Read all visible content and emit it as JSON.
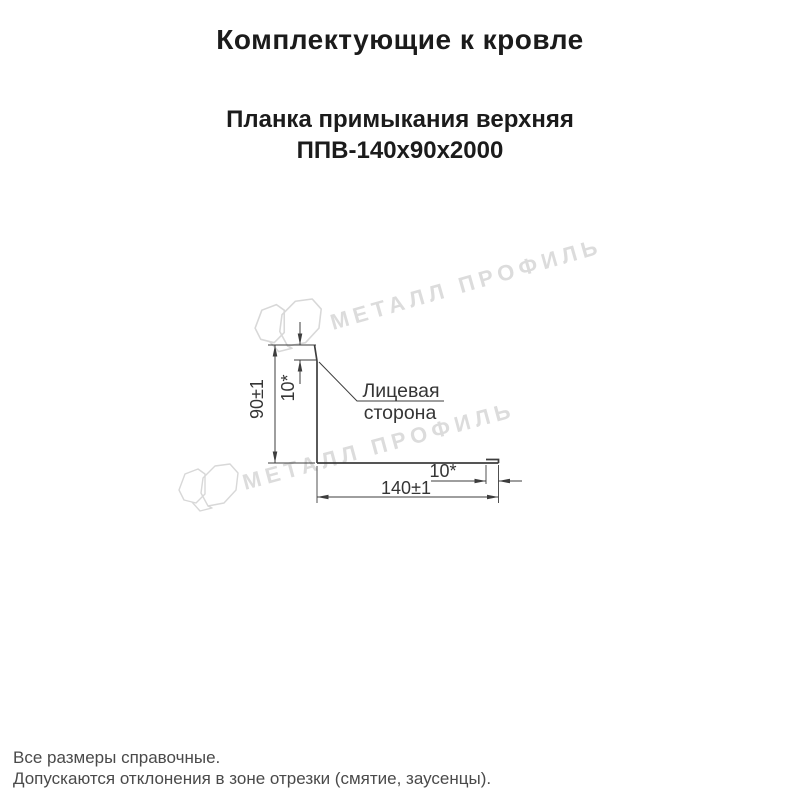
{
  "header": {
    "title": "Комплектующие к кровле"
  },
  "product": {
    "name_line1": "Планка примыкания верхняя",
    "name_line2": "ППВ-140х90х2000"
  },
  "diagram": {
    "dim_height": "90±1",
    "dim_top_hem": "10*",
    "dim_width": "140±1",
    "dim_end_hem": "10*",
    "leader_label_line1": "Лицевая",
    "leader_label_line2": "сторона"
  },
  "watermark": {
    "text": "МЕТАЛЛ ПРОФИЛЬ",
    "color": "#dcdcdc"
  },
  "footer": {
    "line1": "Все размеры справочные.",
    "line2": "Допускаются отклонения в зоне отрезки (смятие, заусенцы)."
  },
  "colors": {
    "background": "#ffffff",
    "title_text": "#1b1b1b",
    "drawing_lines": "#3d3d3d",
    "footer_text": "#4a4a4a",
    "watermark": "#dcdcdc"
  }
}
